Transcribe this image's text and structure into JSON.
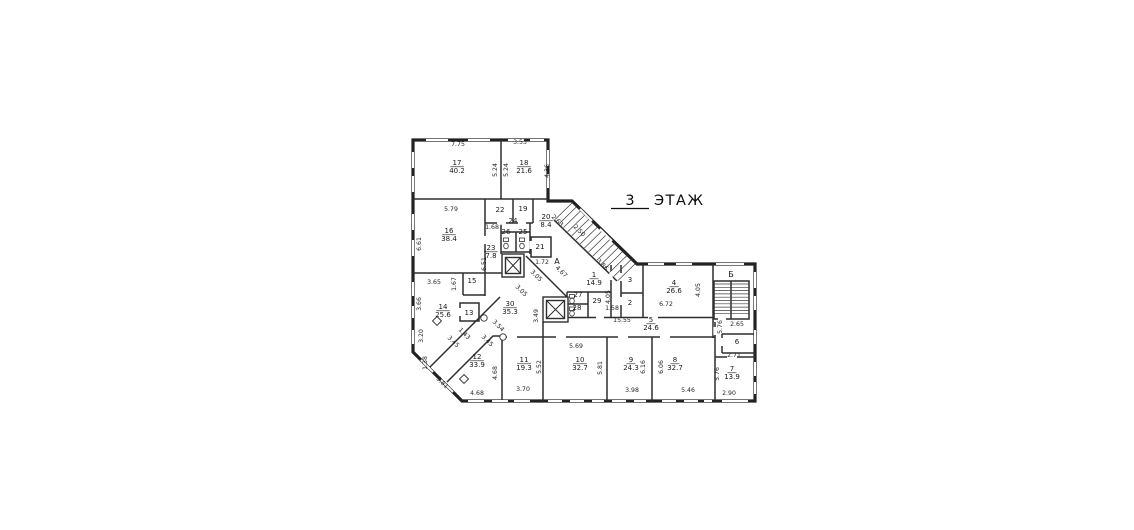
{
  "title": {
    "floor_number": "3",
    "floor_word": "ЭТАЖ"
  },
  "rooms": [
    {
      "number": "1",
      "area": "14.9",
      "x": 594,
      "y": 277
    },
    {
      "number": "2",
      "area": "",
      "x": 630,
      "y": 305
    },
    {
      "number": "3",
      "area": "",
      "x": 630,
      "y": 282
    },
    {
      "number": "4",
      "area": "26.6",
      "x": 674,
      "y": 285
    },
    {
      "number": "5",
      "area": "24.6",
      "x": 651,
      "y": 322
    },
    {
      "number": "6",
      "area": "",
      "x": 737,
      "y": 344
    },
    {
      "number": "7",
      "area": "13.9",
      "x": 732,
      "y": 371
    },
    {
      "number": "8",
      "area": "32.7",
      "x": 675,
      "y": 362
    },
    {
      "number": "9",
      "area": "24.3",
      "x": 631,
      "y": 362
    },
    {
      "number": "10",
      "area": "32.7",
      "x": 580,
      "y": 362
    },
    {
      "number": "11",
      "area": "19.3",
      "x": 524,
      "y": 362
    },
    {
      "number": "12",
      "area": "33.9",
      "x": 477,
      "y": 359
    },
    {
      "number": "13",
      "area": "",
      "x": 469,
      "y": 315
    },
    {
      "number": "14",
      "area": "25.6",
      "x": 443,
      "y": 309
    },
    {
      "number": "15",
      "area": "",
      "x": 472,
      "y": 283
    },
    {
      "number": "16",
      "area": "38.4",
      "x": 449,
      "y": 233
    },
    {
      "number": "17",
      "area": "40.2",
      "x": 457,
      "y": 165
    },
    {
      "number": "18",
      "area": "21.6",
      "x": 524,
      "y": 165
    },
    {
      "number": "19",
      "area": "",
      "x": 523,
      "y": 211
    },
    {
      "number": "20",
      "area": "8.4",
      "x": 546,
      "y": 219
    },
    {
      "number": "21",
      "area": "",
      "x": 540,
      "y": 249
    },
    {
      "number": "22",
      "area": "",
      "x": 500,
      "y": 212
    },
    {
      "number": "23",
      "area": "7.8",
      "x": 491,
      "y": 250
    },
    {
      "number": "24",
      "area": "",
      "x": 513,
      "y": 223
    },
    {
      "number": "25",
      "area": "",
      "x": 523,
      "y": 234
    },
    {
      "number": "26",
      "area": "",
      "x": 506,
      "y": 234
    },
    {
      "number": "27",
      "area": "",
      "x": 578,
      "y": 297
    },
    {
      "number": "28",
      "area": "",
      "x": 577,
      "y": 310
    },
    {
      "number": "29",
      "area": "",
      "x": 597,
      "y": 303
    },
    {
      "number": "30",
      "area": "35.3",
      "x": 510,
      "y": 306
    }
  ],
  "dims": [
    {
      "t": "7.75",
      "x": 458,
      "y": 146,
      "r": 0
    },
    {
      "t": "3.53",
      "x": 520,
      "y": 144,
      "r": 0
    },
    {
      "t": "5.24",
      "x": 497,
      "y": 170,
      "r": -90
    },
    {
      "t": "5.24",
      "x": 508,
      "y": 170,
      "r": -90
    },
    {
      "t": "4.36",
      "x": 549,
      "y": 171,
      "r": -90
    },
    {
      "t": "5.79",
      "x": 451,
      "y": 211,
      "r": 0
    },
    {
      "t": "6.61",
      "x": 421,
      "y": 244,
      "r": -90
    },
    {
      "t": "1.68",
      "x": 492,
      "y": 229,
      "r": 0
    },
    {
      "t": "2.63",
      "x": 556,
      "y": 222,
      "r": 45
    },
    {
      "t": "2.50",
      "x": 578,
      "y": 232,
      "r": 45
    },
    {
      "t": "1.72",
      "x": 542,
      "y": 264,
      "r": 0
    },
    {
      "t": "4.67",
      "x": 560,
      "y": 273,
      "r": 45
    },
    {
      "t": "6.51",
      "x": 486,
      "y": 264,
      "r": -90
    },
    {
      "t": "3.05",
      "x": 535,
      "y": 277,
      "r": 45
    },
    {
      "t": "3.05",
      "x": 520,
      "y": 292,
      "r": 45
    },
    {
      "t": "3.86",
      "x": 601,
      "y": 266,
      "r": 45
    },
    {
      "t": "3.49",
      "x": 538,
      "y": 316,
      "r": -90
    },
    {
      "t": "3.54",
      "x": 497,
      "y": 327,
      "r": 45
    },
    {
      "t": "1.43",
      "x": 463,
      "y": 335,
      "r": 45
    },
    {
      "t": "3.45",
      "x": 486,
      "y": 342,
      "r": 45
    },
    {
      "t": "3.45",
      "x": 452,
      "y": 343,
      "r": 45
    },
    {
      "t": "3.65",
      "x": 434,
      "y": 284,
      "r": 0
    },
    {
      "t": "1.67",
      "x": 456,
      "y": 284,
      "r": -90
    },
    {
      "t": "3.66",
      "x": 421,
      "y": 304,
      "r": -90
    },
    {
      "t": "3.20",
      "x": 423,
      "y": 336,
      "r": -90
    },
    {
      "t": "1.38",
      "x": 427,
      "y": 363,
      "r": -90
    },
    {
      "t": "3.81",
      "x": 441,
      "y": 384,
      "r": 45
    },
    {
      "t": "4.68",
      "x": 497,
      "y": 373,
      "r": -90
    },
    {
      "t": "4.68",
      "x": 477,
      "y": 395,
      "r": 0
    },
    {
      "t": "3.70",
      "x": 523,
      "y": 391,
      "r": 0
    },
    {
      "t": "5.52",
      "x": 541,
      "y": 367,
      "r": -90
    },
    {
      "t": "5.69",
      "x": 576,
      "y": 348,
      "r": 0
    },
    {
      "t": "5.81",
      "x": 602,
      "y": 368,
      "r": -90
    },
    {
      "t": "3.98",
      "x": 632,
      "y": 392,
      "r": 0
    },
    {
      "t": "6.16",
      "x": 645,
      "y": 367,
      "r": -90
    },
    {
      "t": "6.06",
      "x": 663,
      "y": 367,
      "r": -90
    },
    {
      "t": "5.46",
      "x": 688,
      "y": 392,
      "r": 0
    },
    {
      "t": "5.76",
      "x": 719,
      "y": 374,
      "r": -90
    },
    {
      "t": "2.90",
      "x": 729,
      "y": 395,
      "r": 0
    },
    {
      "t": "2.71",
      "x": 734,
      "y": 357,
      "r": 0
    },
    {
      "t": "2.65",
      "x": 737,
      "y": 326,
      "r": 0
    },
    {
      "t": "5.76",
      "x": 722,
      "y": 327,
      "r": -90
    },
    {
      "t": "15.55",
      "x": 622,
      "y": 322,
      "r": 0
    },
    {
      "t": "1.58",
      "x": 612,
      "y": 310,
      "r": 0
    },
    {
      "t": "6.72",
      "x": 666,
      "y": 306,
      "r": 0
    },
    {
      "t": "4.05",
      "x": 610,
      "y": 297,
      "r": -90
    },
    {
      "t": "4.05",
      "x": 700,
      "y": 290,
      "r": -90
    }
  ],
  "stair_labels": [
    {
      "t": "А",
      "x": 557,
      "y": 264
    },
    {
      "t": "Б",
      "x": 731,
      "y": 277
    }
  ]
}
